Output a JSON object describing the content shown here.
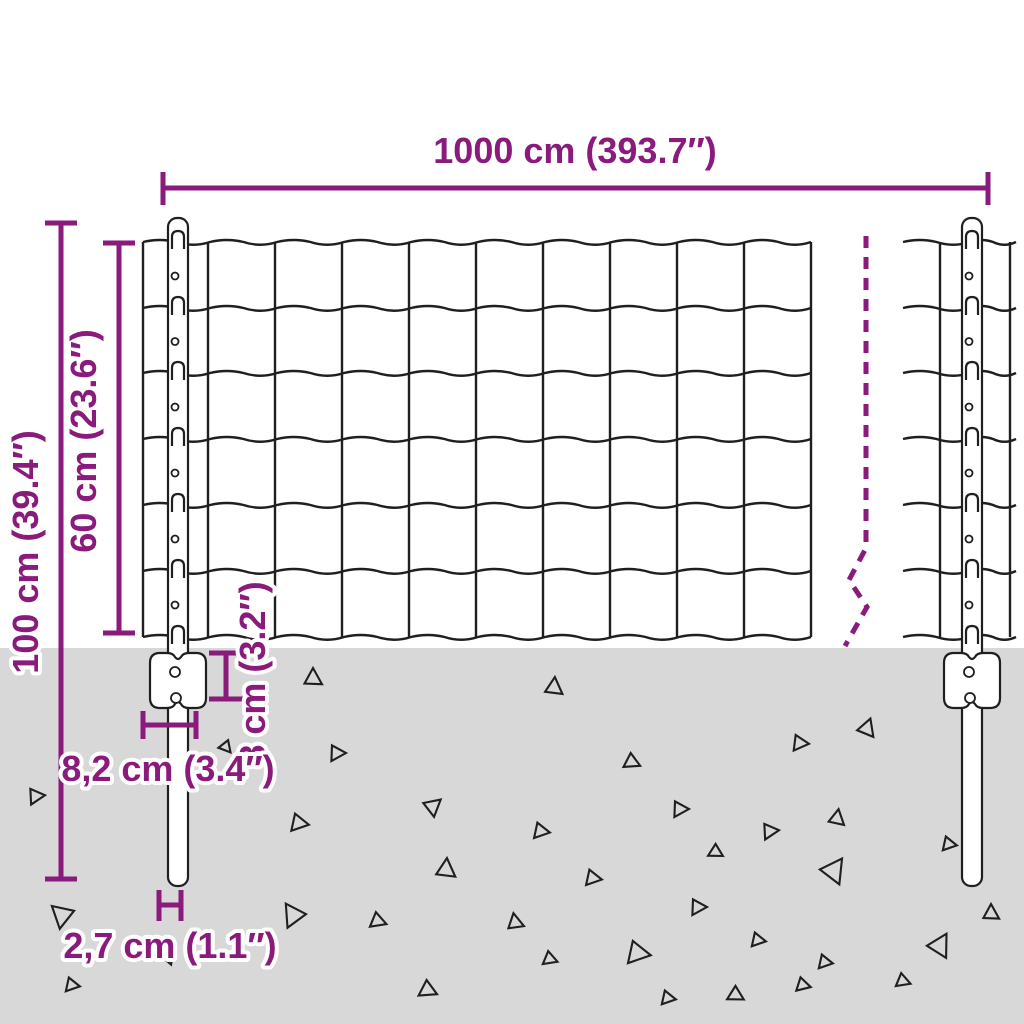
{
  "diagram": {
    "type": "fence-dimension-diagram",
    "labels": {
      "fence_length": "1000 cm (393.7″)",
      "total_height": "100 cm (39.4″)",
      "mesh_height": "60 cm (23.6″)",
      "anchor_depth": "8 cm (3.2″)",
      "anchor_width": "8,2 cm (3.4″)",
      "post_diameter": "2,7 cm (1.1″)"
    },
    "colors": {
      "dimension_accent": "#8A1A7C",
      "line": "#1F1F1F",
      "ground": "#D8D8D8",
      "background": "#FFFFFF"
    }
  }
}
